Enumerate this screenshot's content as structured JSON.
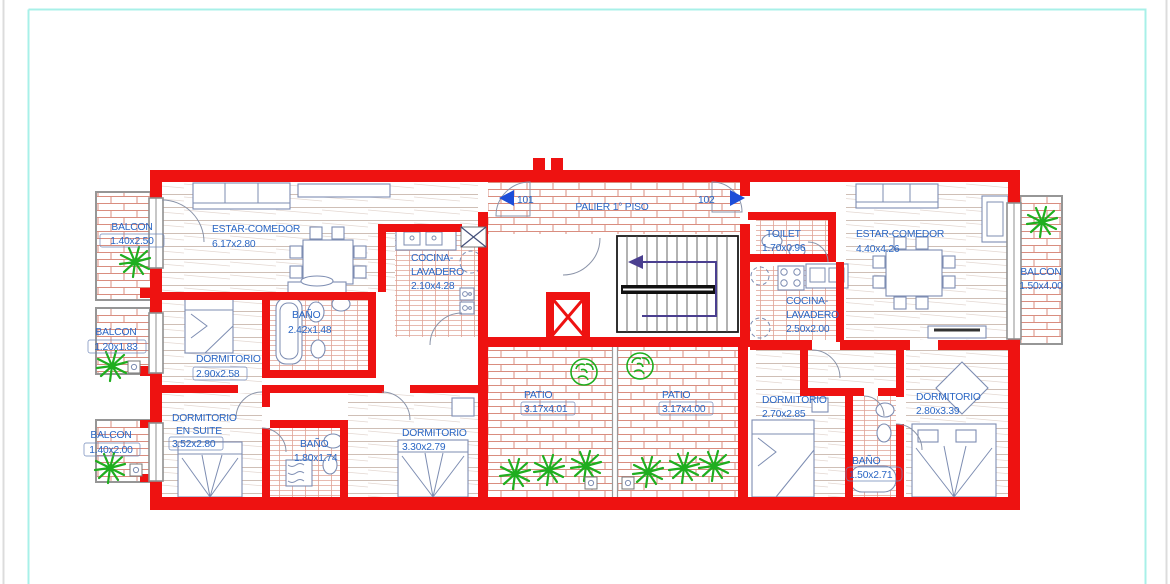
{
  "plan": {
    "palier": {
      "label": "PALIER 1° PISO"
    },
    "doors": {
      "left_unit": "101",
      "right_unit": "102"
    },
    "rooms": {
      "balcon_tl": [
        "BALCON",
        "1.40x2.50"
      ],
      "estar_izq": [
        "ESTAR-COMEDOR",
        "6.17x2.80"
      ],
      "cocina_izq": [
        "COCINA-",
        "LAVADERO",
        "2.10x4.28"
      ],
      "balcon_izq2": [
        "BALCON",
        "1.20x1.83"
      ],
      "bano1": [
        "BAÑO",
        "2.42x1.48"
      ],
      "dorm1": [
        "DORMITORIO",
        "2.90x2.58"
      ],
      "balcon_izq3": [
        "BALCON",
        "1.40x2.00"
      ],
      "dorm_suite": [
        "DORMITORIO",
        "EN SUITE",
        "3.52x2.80"
      ],
      "bano2": [
        "BAÑO",
        "1.80x1.74"
      ],
      "dorm2": [
        "DORMITORIO",
        "3.30x2.79"
      ],
      "patio_izq": [
        "PATIO",
        "3.17x4.01"
      ],
      "patio_der": [
        "PATIO",
        "3.17x4.00"
      ],
      "toilet": [
        "TOILET",
        "1.70x0.96"
      ],
      "estar_der": [
        "ESTAR-COMEDOR",
        "4.40x4.26"
      ],
      "cocina_der": [
        "COCINA-",
        "LAVADERO",
        "2.50x2.00"
      ],
      "balcon_der": [
        "BALCON",
        "1.50x4.00"
      ],
      "dorm3": [
        "DORMITORIO",
        "2.70x2.85"
      ],
      "dorm4": [
        "DORMITORIO",
        "2.80x3.39"
      ],
      "bano3": [
        "BAÑO",
        "1.50x2.71"
      ]
    },
    "colors": {
      "wall": "#ee1211",
      "text": "#2a66c4",
      "plant": "#1fae1f",
      "page_border": "#a8f0e8",
      "stairs_arrow": "#4a3f8f"
    }
  }
}
